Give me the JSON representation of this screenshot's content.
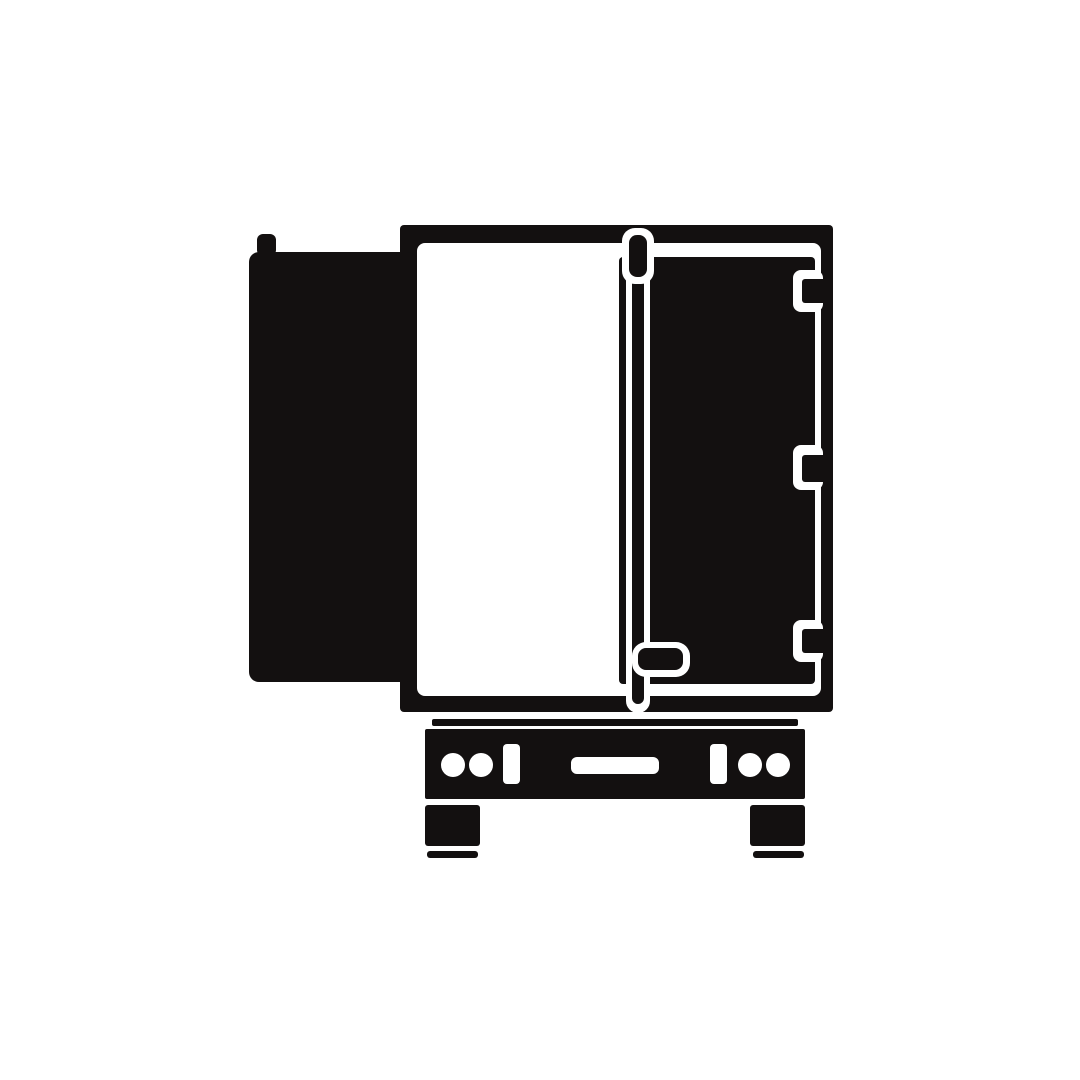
{
  "icon": {
    "name": "semi-trailer-rear-view-open-door-icon",
    "description": "Black flat silhouette icon of a semi trailer seen from the rear with the left door swung open and the right door closed",
    "canvas": {
      "width": 1080,
      "height": 1080
    },
    "colors": {
      "ink": "#131010",
      "paper": "#ffffff"
    },
    "shapes": [
      {
        "name": "trailer-frame",
        "type": "rect",
        "x": 400,
        "y": 225,
        "w": 433,
        "h": 487,
        "rx": 4,
        "fill": "ink"
      },
      {
        "name": "trailer-interior",
        "type": "rect",
        "x": 417,
        "y": 243,
        "w": 404,
        "h": 453,
        "rx": 8,
        "fill": "paper"
      },
      {
        "name": "right-door",
        "type": "rect",
        "x": 619,
        "y": 257,
        "w": 196,
        "h": 427,
        "rx": 4,
        "fill": "ink"
      },
      {
        "name": "hinge-notch-top",
        "type": "rect",
        "x": 793,
        "y": 270,
        "w": 30,
        "h": 42,
        "rx": 8,
        "fill": "paper"
      },
      {
        "name": "hinge-notch-middle",
        "type": "rect",
        "x": 793,
        "y": 445,
        "w": 30,
        "h": 45,
        "rx": 8,
        "fill": "paper"
      },
      {
        "name": "hinge-notch-bottom",
        "type": "rect",
        "x": 793,
        "y": 620,
        "w": 30,
        "h": 42,
        "rx": 8,
        "fill": "paper"
      },
      {
        "name": "hinge-tab-top",
        "type": "rect",
        "x": 802,
        "y": 279,
        "w": 31,
        "h": 24,
        "rx": 3,
        "fill": "ink"
      },
      {
        "name": "hinge-tab-middle",
        "type": "rect",
        "x": 802,
        "y": 455,
        "w": 31,
        "h": 27,
        "rx": 3,
        "fill": "ink"
      },
      {
        "name": "hinge-tab-bottom",
        "type": "rect",
        "x": 802,
        "y": 629,
        "w": 31,
        "h": 24,
        "rx": 3,
        "fill": "ink"
      },
      {
        "name": "lock-rod-outline",
        "type": "rect",
        "x": 626,
        "y": 240,
        "w": 24,
        "h": 473,
        "rx": 12,
        "fill": "paper"
      },
      {
        "name": "lock-rod",
        "type": "rect",
        "x": 632,
        "y": 246,
        "w": 12,
        "h": 458,
        "rx": 6,
        "fill": "ink"
      },
      {
        "name": "rod-knob-outline",
        "type": "rect",
        "x": 622,
        "y": 228,
        "w": 32,
        "h": 56,
        "rx": 13,
        "fill": "paper"
      },
      {
        "name": "rod-knob",
        "type": "rect",
        "x": 629,
        "y": 235,
        "w": 18,
        "h": 42,
        "rx": 8,
        "fill": "ink"
      },
      {
        "name": "door-handle-outline",
        "type": "rect",
        "x": 632,
        "y": 642,
        "w": 58,
        "h": 35,
        "rx": 14,
        "fill": "paper"
      },
      {
        "name": "door-handle",
        "type": "rect",
        "x": 638,
        "y": 648,
        "w": 45,
        "h": 22,
        "rx": 8,
        "fill": "ink"
      },
      {
        "name": "left-door-hinge-pin",
        "type": "rect",
        "x": 257,
        "y": 234,
        "w": 19,
        "h": 22,
        "rx": 6,
        "fill": "ink"
      },
      {
        "name": "left-door-open",
        "type": "rect",
        "x": 249,
        "y": 252,
        "w": 168,
        "h": 430,
        "rx": 10,
        "fill": "ink"
      },
      {
        "name": "chassis-bar",
        "type": "rect",
        "x": 432,
        "y": 719,
        "w": 366,
        "h": 7,
        "rx": 2,
        "fill": "ink"
      },
      {
        "name": "bumper",
        "type": "rect",
        "x": 425,
        "y": 729,
        "w": 380,
        "h": 70,
        "rx": 2,
        "fill": "ink"
      },
      {
        "name": "taillight-left-outer",
        "type": "circle",
        "cx": 453,
        "cy": 765,
        "r": 12,
        "fill": "paper"
      },
      {
        "name": "taillight-left-inner",
        "type": "circle",
        "cx": 481,
        "cy": 765,
        "r": 12,
        "fill": "paper"
      },
      {
        "name": "reflector-left",
        "type": "rect",
        "x": 503,
        "y": 744,
        "w": 17,
        "h": 40,
        "rx": 4,
        "fill": "paper"
      },
      {
        "name": "license-plate",
        "type": "rect",
        "x": 571,
        "y": 757,
        "w": 88,
        "h": 17,
        "rx": 6,
        "fill": "paper"
      },
      {
        "name": "reflector-right",
        "type": "rect",
        "x": 710,
        "y": 744,
        "w": 17,
        "h": 40,
        "rx": 4,
        "fill": "paper"
      },
      {
        "name": "taillight-right-inner",
        "type": "circle",
        "cx": 750,
        "cy": 765,
        "r": 12,
        "fill": "paper"
      },
      {
        "name": "taillight-right-outer",
        "type": "circle",
        "cx": 778,
        "cy": 765,
        "r": 12,
        "fill": "paper"
      },
      {
        "name": "wheel-left",
        "type": "rect",
        "x": 425,
        "y": 805,
        "w": 55,
        "h": 41,
        "rx": 3,
        "fill": "ink"
      },
      {
        "name": "wheel-left-ground",
        "type": "rect",
        "x": 427,
        "y": 851,
        "w": 51,
        "h": 7,
        "rx": 3,
        "fill": "ink"
      },
      {
        "name": "wheel-right",
        "type": "rect",
        "x": 750,
        "y": 805,
        "w": 55,
        "h": 41,
        "rx": 3,
        "fill": "ink"
      },
      {
        "name": "wheel-right-ground",
        "type": "rect",
        "x": 753,
        "y": 851,
        "w": 51,
        "h": 7,
        "rx": 3,
        "fill": "ink"
      }
    ]
  }
}
